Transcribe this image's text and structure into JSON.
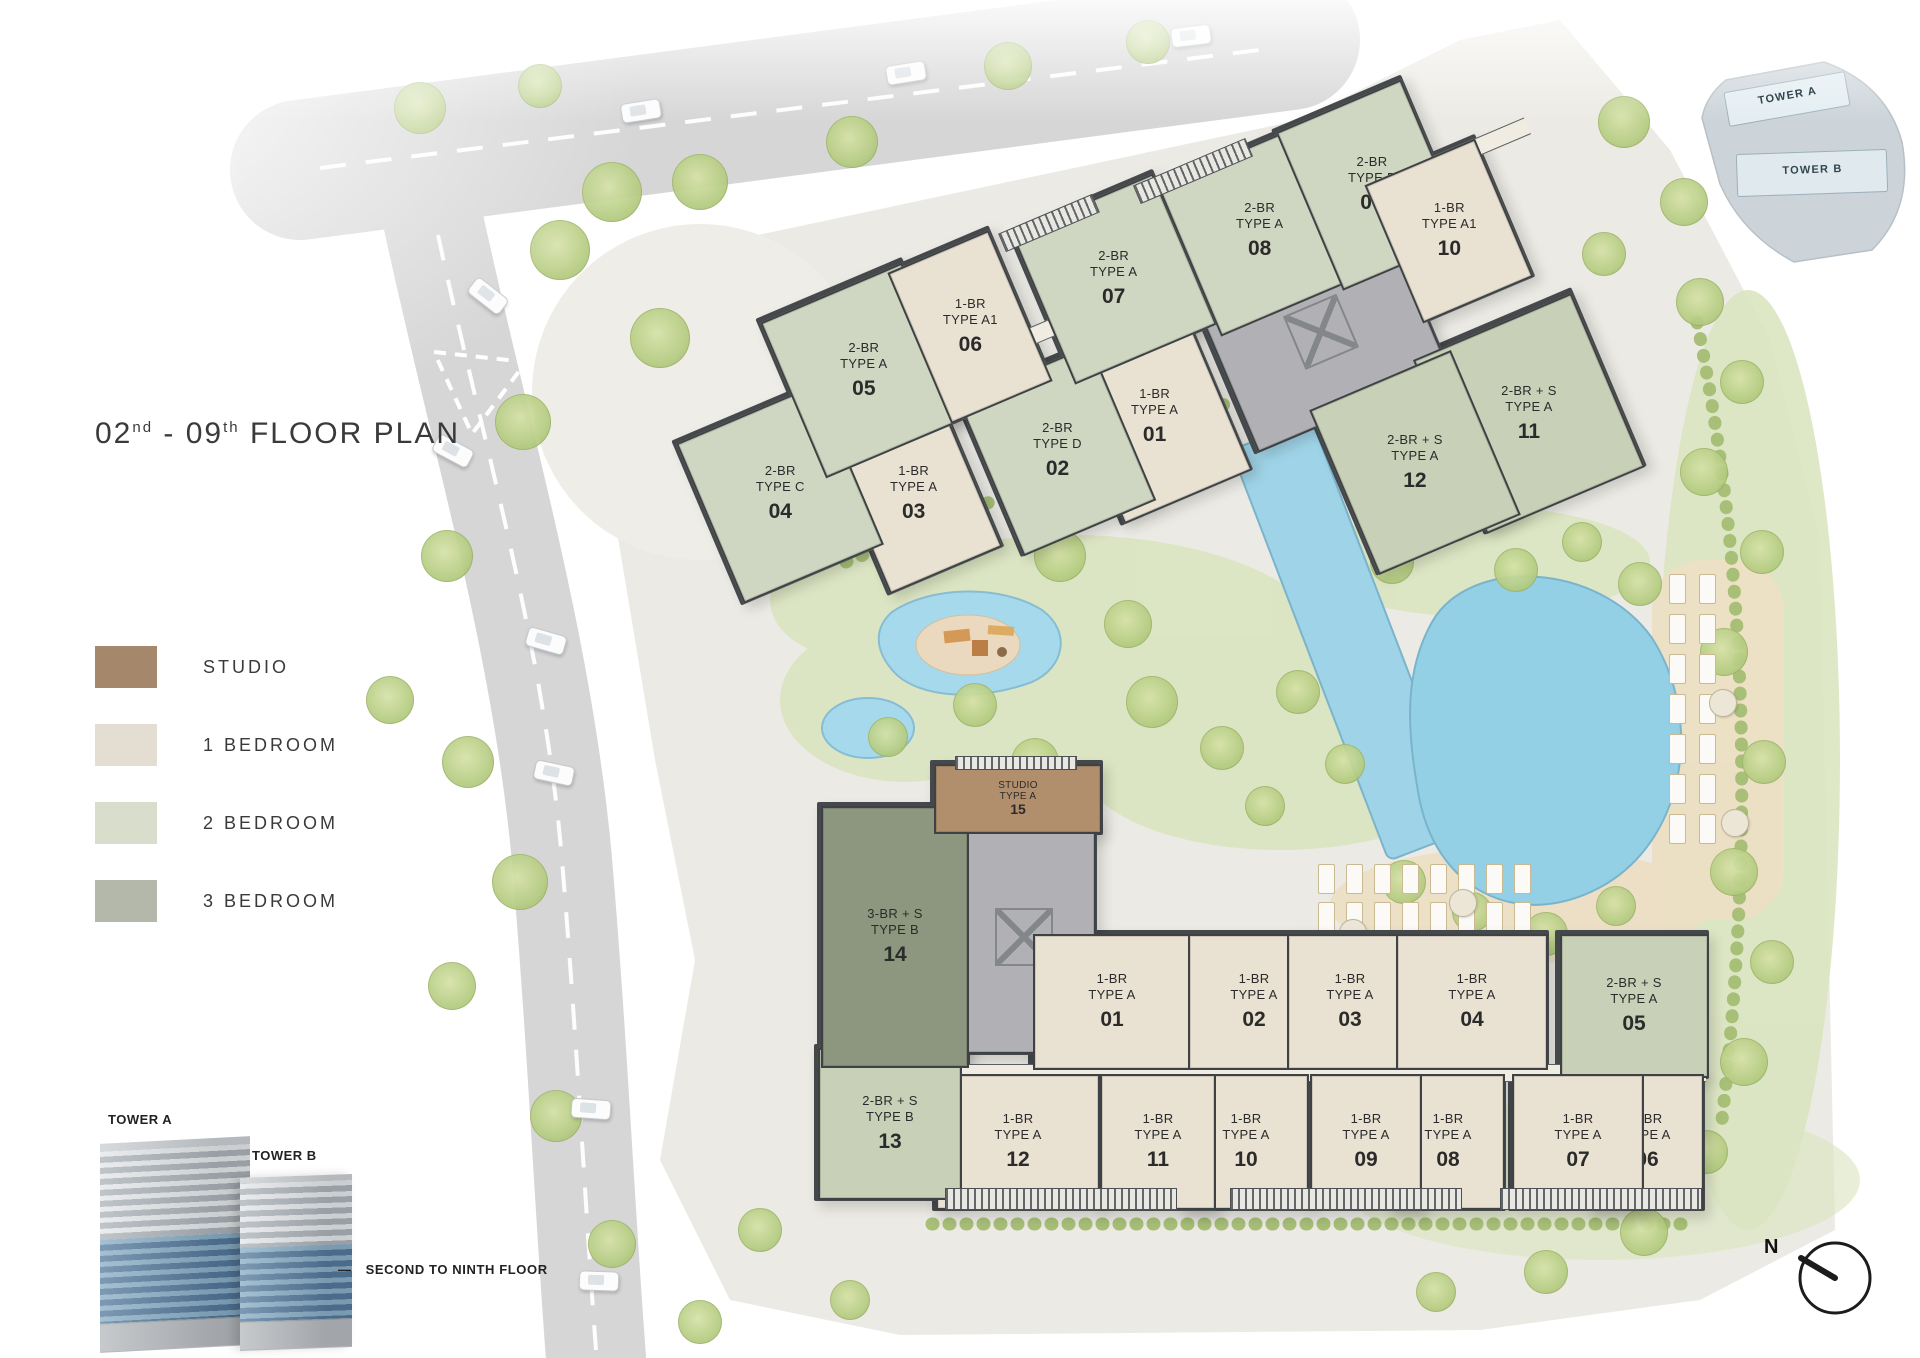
{
  "title": {
    "num1": "02",
    "sup1": "nd",
    "sep": " - ",
    "num2": "09",
    "sup2": "th",
    "rest": " FLOOR PLAN"
  },
  "legend": {
    "items": [
      {
        "label": "STUDIO",
        "color": "#a5876b"
      },
      {
        "label": "1 BEDROOM",
        "color": "#e4ddd1"
      },
      {
        "label": "2 BEDROOM",
        "color": "#d9ddcb"
      },
      {
        "label": "3 BEDROOM",
        "color": "#b3b8aa"
      }
    ]
  },
  "keyplan": {
    "tower_a_label": "TOWER A",
    "tower_b_label": "TOWER B"
  },
  "elevation": {
    "tower_a_label": "TOWER A",
    "tower_b_label": "TOWER B",
    "note_dash": "—",
    "note": "SECOND TO NINTH FLOOR"
  },
  "compass": {
    "north_label": "N"
  },
  "unit_colors": {
    "studio": "#b18f6d",
    "br1": "#e9e1d2",
    "br2": "#cfd6c1",
    "br2s": "#c8d1b8",
    "br3s": "#8d977f",
    "core": "#b1b1b5"
  },
  "tower_a_units": [
    {
      "num": "01",
      "line1": "1-BR",
      "line2": "TYPE A",
      "type": "br1"
    },
    {
      "num": "02",
      "line1": "2-BR",
      "line2": "TYPE D",
      "type": "br2"
    },
    {
      "num": "03",
      "line1": "1-BR",
      "line2": "TYPE A",
      "type": "br1"
    },
    {
      "num": "04",
      "line1": "2-BR",
      "line2": "TYPE C",
      "type": "br2"
    },
    {
      "num": "05",
      "line1": "2-BR",
      "line2": "TYPE A",
      "type": "br2"
    },
    {
      "num": "06",
      "line1": "1-BR",
      "line2": "TYPE A1",
      "type": "br1"
    },
    {
      "num": "07",
      "line1": "2-BR",
      "line2": "TYPE A",
      "type": "br2"
    },
    {
      "num": "08",
      "line1": "2-BR",
      "line2": "TYPE A",
      "type": "br2"
    },
    {
      "num": "09",
      "line1": "2-BR",
      "line2": "TYPE B",
      "type": "br2"
    },
    {
      "num": "10",
      "line1": "1-BR",
      "line2": "TYPE A1",
      "type": "br1"
    },
    {
      "num": "11",
      "line1": "2-BR + S",
      "line2": "TYPE A",
      "type": "br2s"
    },
    {
      "num": "12",
      "line1": "2-BR + S",
      "line2": "TYPE A",
      "type": "br2s"
    }
  ],
  "tower_b_units": [
    {
      "num": "01",
      "line1": "1-BR",
      "line2": "TYPE A",
      "type": "br1"
    },
    {
      "num": "02",
      "line1": "1-BR",
      "line2": "TYPE A",
      "type": "br1"
    },
    {
      "num": "03",
      "line1": "1-BR",
      "line2": "TYPE A",
      "type": "br1"
    },
    {
      "num": "04",
      "line1": "1-BR",
      "line2": "TYPE A",
      "type": "br1"
    },
    {
      "num": "05",
      "line1": "2-BR + S",
      "line2": "TYPE A",
      "type": "br2s"
    },
    {
      "num": "06",
      "line1": "1-BR",
      "line2": "TYPE A",
      "type": "br1"
    },
    {
      "num": "07",
      "line1": "1-BR",
      "line2": "TYPE A",
      "type": "br1"
    },
    {
      "num": "08",
      "line1": "1-BR",
      "line2": "TYPE A",
      "type": "br1"
    },
    {
      "num": "09",
      "line1": "1-BR",
      "line2": "TYPE A",
      "type": "br1"
    },
    {
      "num": "10",
      "line1": "1-BR",
      "line2": "TYPE A",
      "type": "br1"
    },
    {
      "num": "11",
      "line1": "1-BR",
      "line2": "TYPE A",
      "type": "br1"
    },
    {
      "num": "12",
      "line1": "1-BR",
      "line2": "TYPE A",
      "type": "br1"
    },
    {
      "num": "13",
      "line1": "2-BR + S",
      "line2": "TYPE B",
      "type": "br2s"
    },
    {
      "num": "14",
      "line1": "3-BR + S",
      "line2": "TYPE B",
      "type": "br3s"
    },
    {
      "num": "15",
      "line1": "STUDIO",
      "line2": "TYPE A",
      "type": "studio"
    }
  ]
}
